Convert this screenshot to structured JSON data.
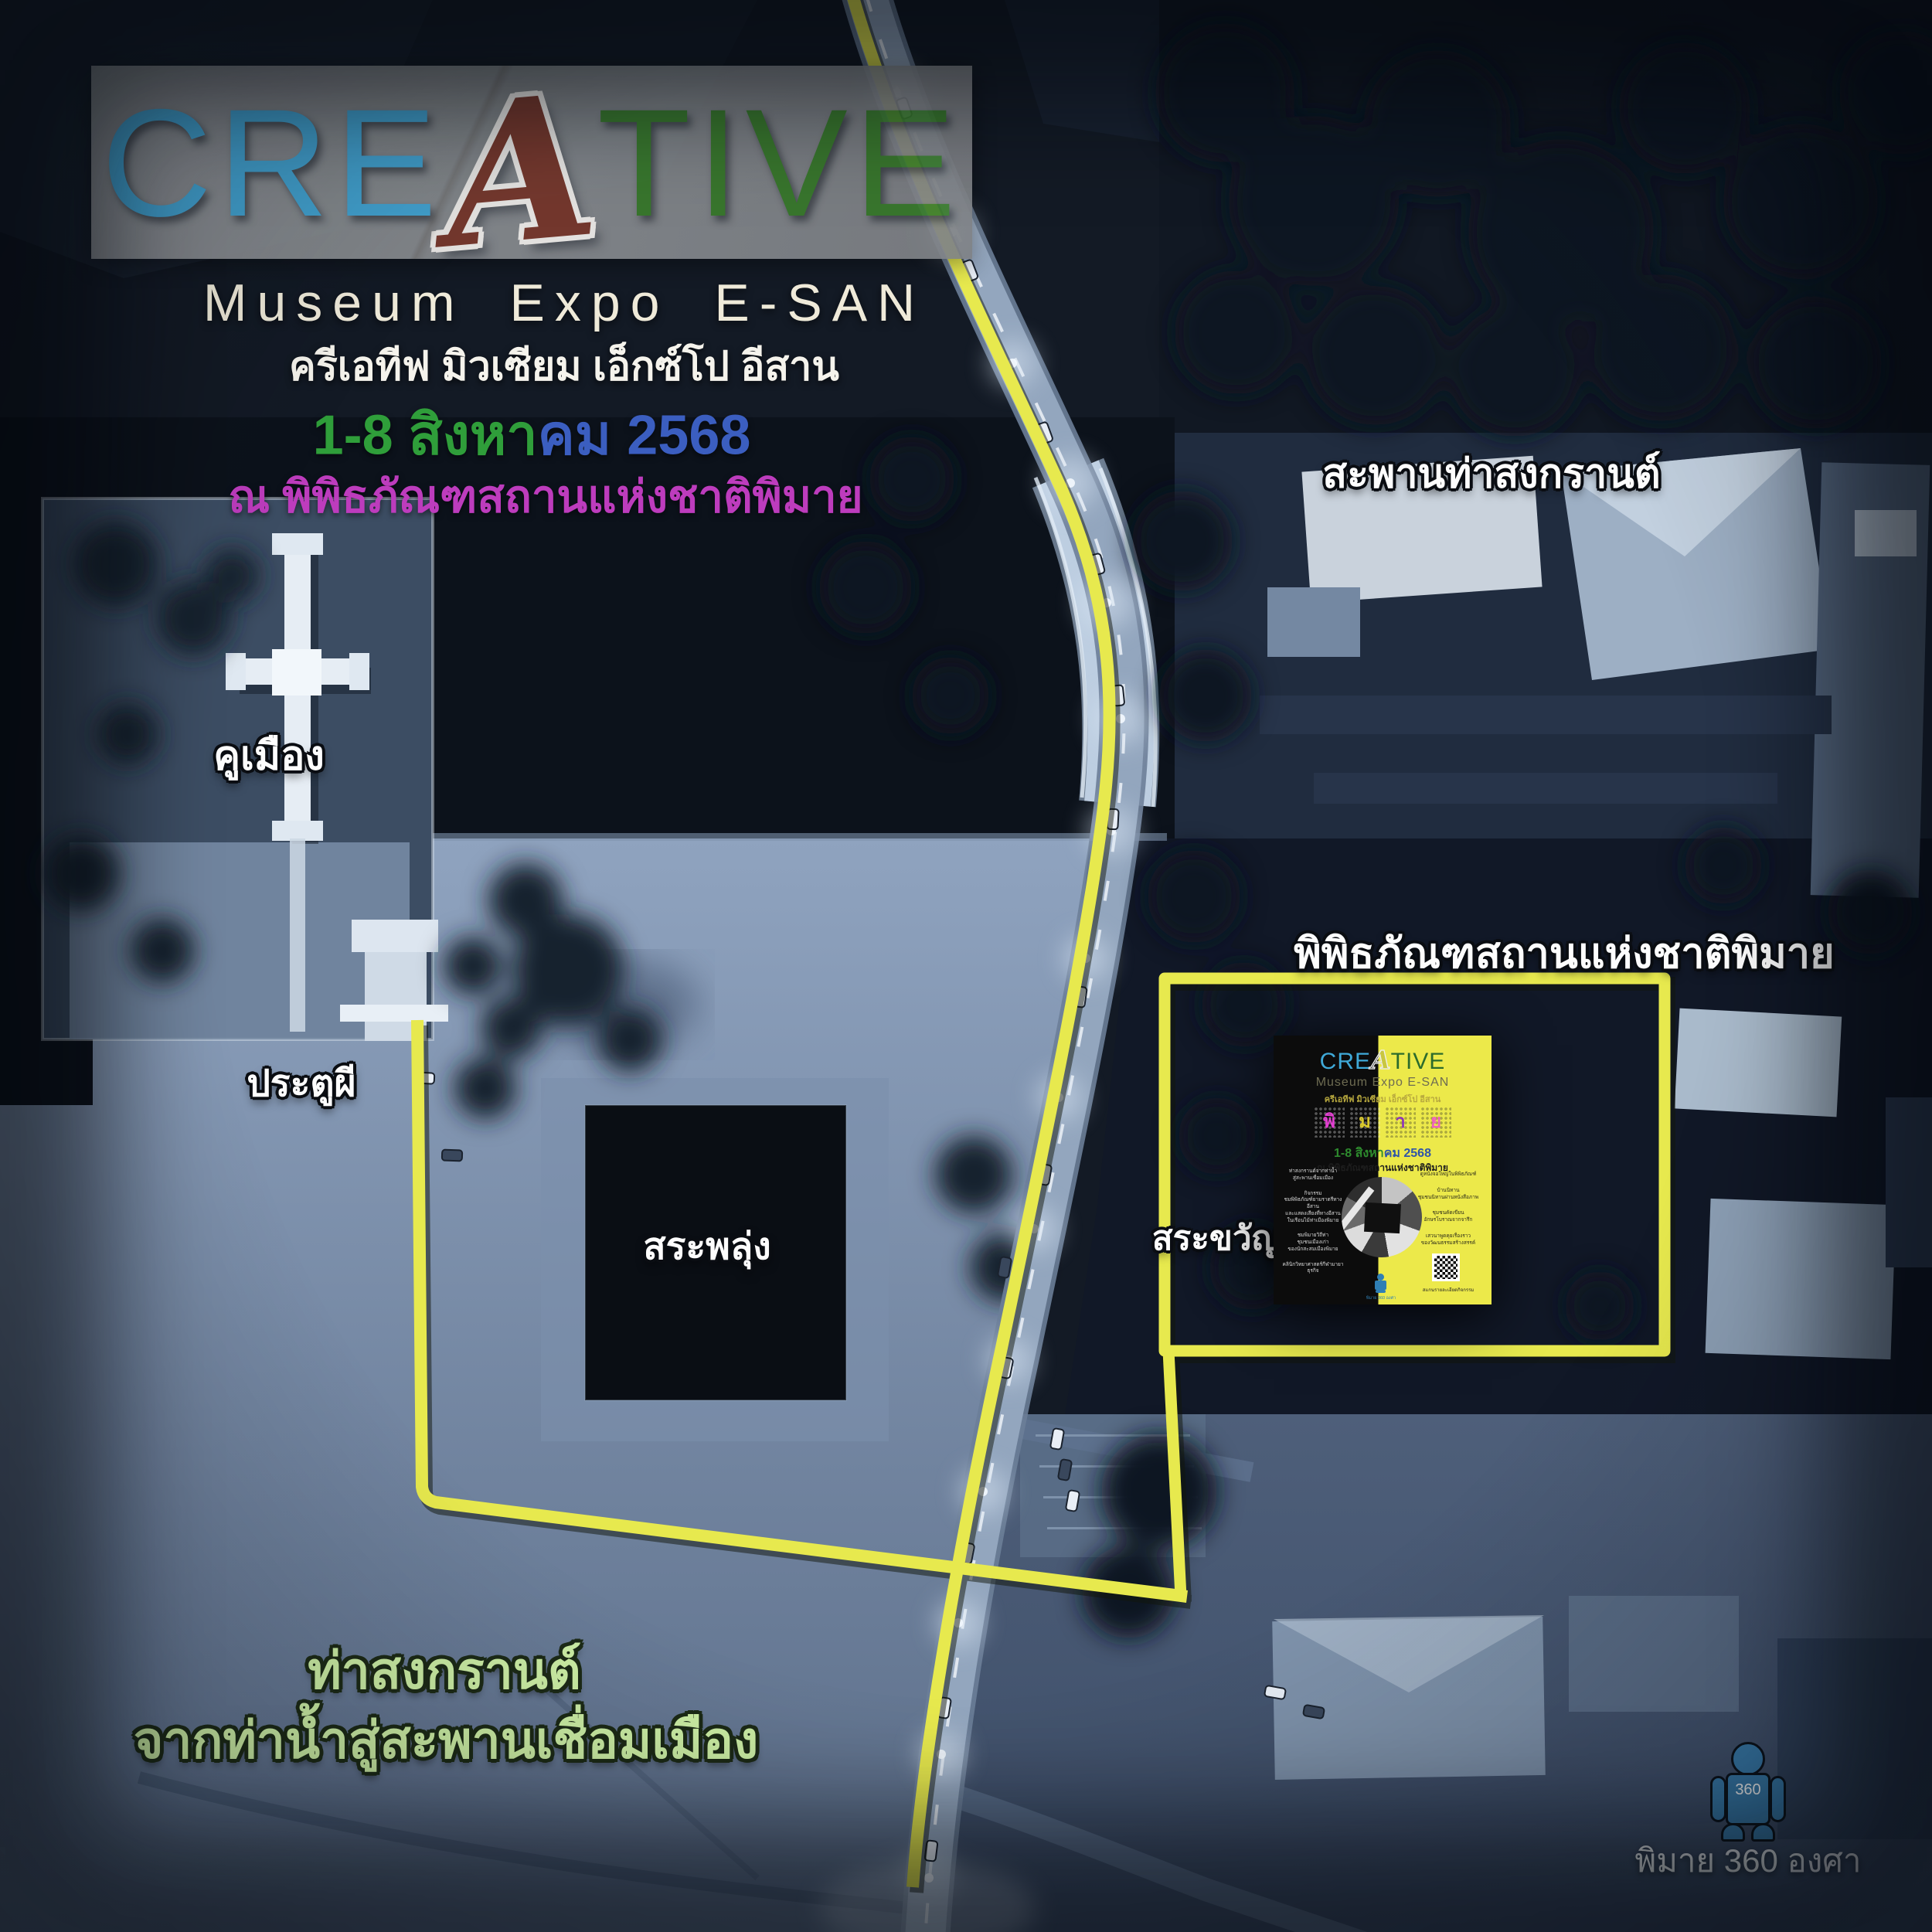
{
  "header": {
    "logo": {
      "cre": "CRE",
      "a": "A",
      "tive": "TIVE"
    },
    "title_en": "Museum Expo E-SAN",
    "title_th": "ครีเอทีฟ มิวเซียม เอ็กซ์โป อีสาน",
    "date_green": "1-8 สิงหา",
    "date_blue": "คม 2568",
    "venue": "ณ พิพิธภัณฑสถานแห่งชาติพิมาย"
  },
  "map_labels": {
    "bridge": "สะพานท่าสงกรานต์",
    "moat": "คูเมือง",
    "ghost_gate": "ประตูผี",
    "pond_phlung": "สระพลุ่ง",
    "pond_khwan": "สระขวัญ",
    "museum": "พิพิธภัณฑสถานแห่งชาติพิมาย",
    "pier_title": "ท่าสงกรานต์",
    "pier_subtitle": "จากท่าน้ำสู่สะพานเชื่อมเมือง"
  },
  "badge_360": {
    "label": "พิมาย 360 องศา",
    "figure_text": "360"
  },
  "poster": {
    "logo_cre": "CRE",
    "logo_a": "A",
    "logo_tive": "TIVE",
    "title_en": "Museum Expo E-SAN",
    "title_th": "ครีเอทีฟ มิวเซียม เอ็กซ์โป อีสาน",
    "phimai": [
      "พิ",
      "ม",
      "า",
      "ย"
    ],
    "date_green": "1-8 สิงหา",
    "date_blue": "คม 2568",
    "venue": "ณ พิพิธภัณฑสถานแห่งชาติพิมาย",
    "left_items": [
      "ท่าสงกรานต์จากท่าน้ำ\nสู่สะพานเชื่อมเมือง",
      "กิจกรรม\nชมพิพิธภัณฑ์ยามราตรีทางอีสาน\nและแสดงเสียงที่ทางอีสาน\nในเรือนไม้ท่าเมืองพิมาย",
      "ชมพิมายวิถีท่า\nชุมชนเมืองเก่า\nของนักสะสมเมืองพิมาย",
      "คลินิกวิทยาศาสตร์กีฬามายาธุรกิจ"
    ],
    "right_items": [
      "ดูหนังจอใหญ่ในพิพิธภัณฑ์",
      "บ้านนิทาน\nชุมชนนิทานผ่านหนังสือภาพ",
      "ชุมชนคัดเขียน\nอักษรโบราณจากจารึก",
      "เสวนาพูดคุยเรื่องราว\nของวัฒนธรรมสร้างสรรค์"
    ],
    "qr_caption": "สแกนรายละเอียดกิจกรรม",
    "mini_badge": "พิมาย 360 องศา"
  },
  "colors": {
    "route_yellow": "#e7e94e",
    "logo_blue": "#45a8d8",
    "logo_brown": "#7b3b2f",
    "logo_green": "#3c7d2f",
    "date_green": "#2f9e3a",
    "date_blue": "#3b5ec0",
    "venue_magenta": "#bd3cbd",
    "pier_text_green": "#cdefa5",
    "figure_blue": "#3a7dad",
    "poster_yellow": "#ece94a"
  }
}
